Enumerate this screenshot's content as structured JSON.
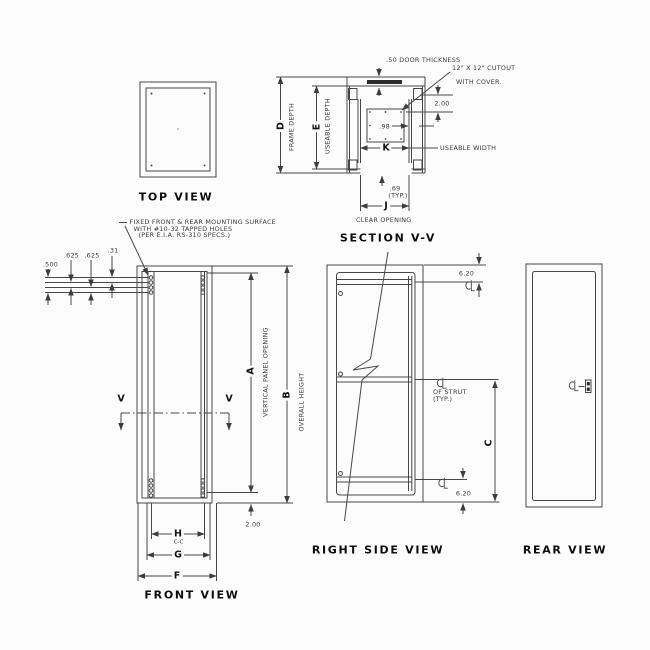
{
  "views": {
    "top_view": "TOP VIEW",
    "section": "SECTION V-V",
    "front_view": "FRONT VIEW",
    "right_side_view": "RIGHT SIDE VIEW",
    "rear_view": "REAR VIEW"
  },
  "section_view": {
    "door_thickness": ".50 DOOR THICKNESS",
    "cutout_note_line1": "12\" X 12\" CUTOUT",
    "cutout_note_line2": "WITH COVER.",
    "dim_cutout_offset": "2.00",
    "dim_98": ".98",
    "dim_k": "K",
    "useable_width_label": "USEABLE WIDTH",
    "dim_69": ".69",
    "typ": "(TYP.)",
    "dim_j": "J",
    "clear_opening_label": "CLEAR OPENING",
    "dim_d": "D",
    "frame_depth_label": "FRAME DEPTH",
    "dim_e": "E",
    "useable_depth_label": "USEABLE DEPTH"
  },
  "front_view": {
    "mounting_note_line1": "FIXED FRONT & REAR MOUNTING SURFACE",
    "mounting_note_line2": "WITH #10-32 TAPPED HOLES",
    "mounting_note_line3": "(PER E.I.A. RS-310 SPECS.)",
    "dim_500": ".500",
    "dim_625_a": ".625",
    "dim_625_b": ".625",
    "dim_31": ".31",
    "section_cut_label": "V",
    "dim_a": "A",
    "vertical_panel_opening_label": "VERTICAL PANEL OPENING",
    "dim_b": "B",
    "overall_height_label": "OVERALL HEIGHT",
    "dim_200": "2.00",
    "dim_h": "H",
    "dim_h_sub": "C-C",
    "dim_g": "G",
    "dim_f": "F"
  },
  "right_side_view": {
    "dim_620_top": "6.20",
    "strut_note_line1": "OF STRUT",
    "strut_note_line2": "(TYP.)",
    "dim_c": "C",
    "dim_620_bottom": "6.20"
  },
  "icons": {
    "centerline_symbol": "centerline-mark"
  }
}
